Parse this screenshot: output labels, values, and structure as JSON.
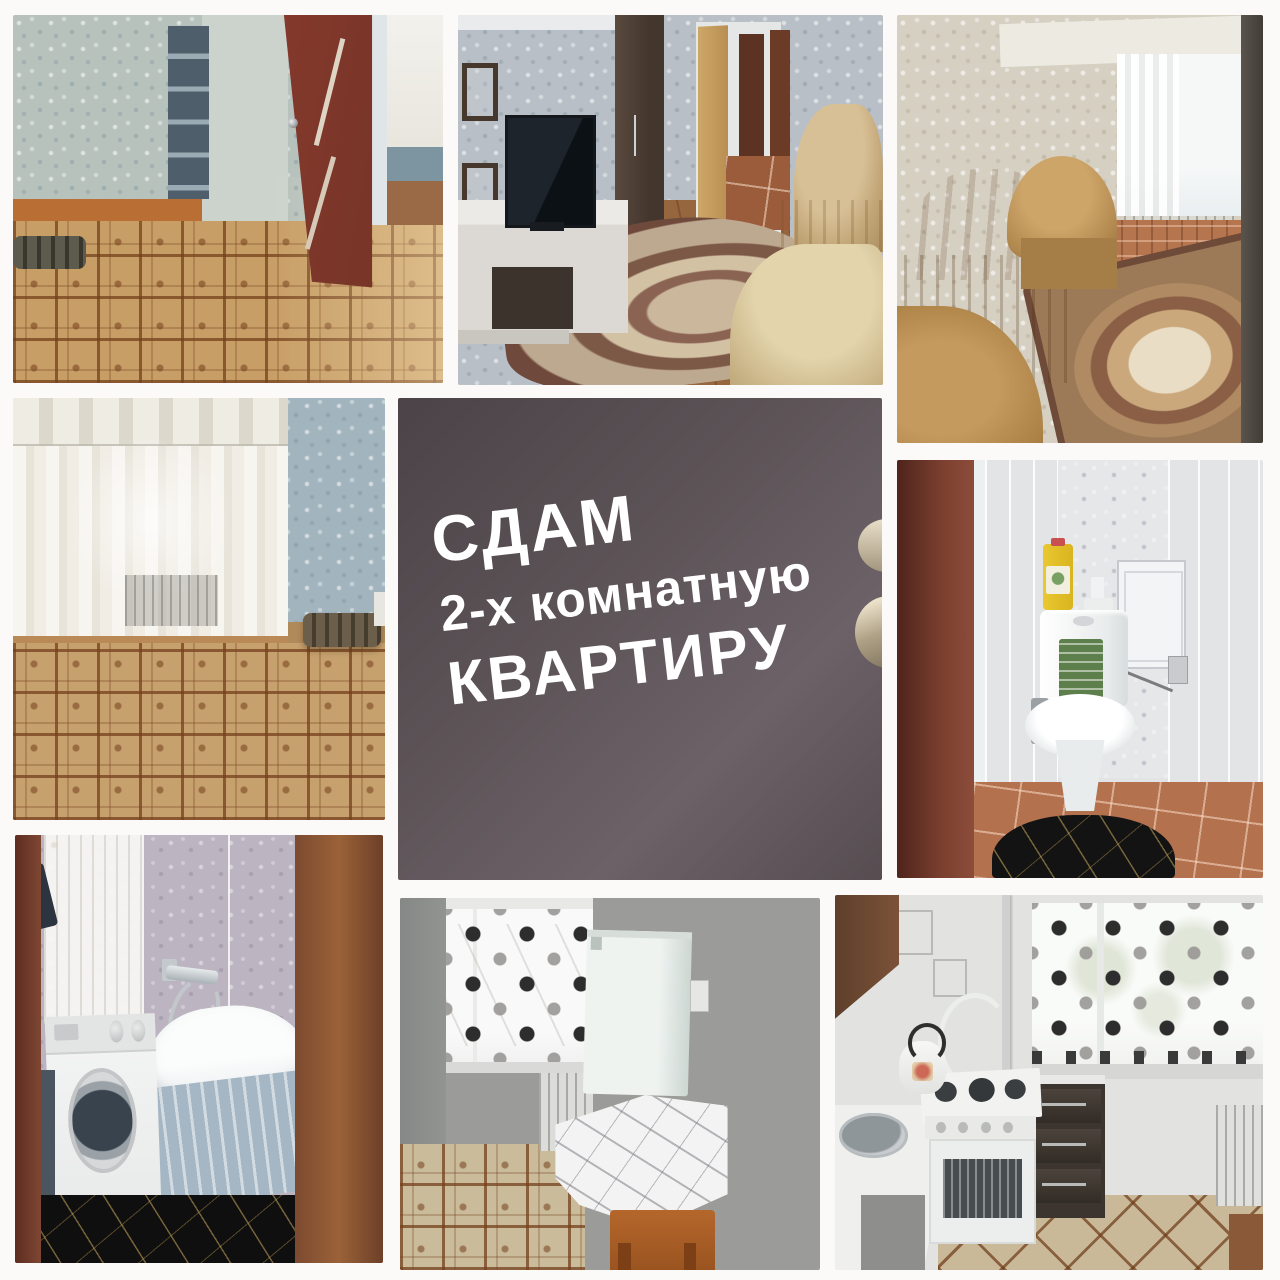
{
  "collage": {
    "background_color": "#fcfaf8",
    "title_card": {
      "line1": "СДАМ",
      "line2": "2-х комнатную",
      "line3": "КВАРТИРУ",
      "background_color": "#5a5156",
      "text_color": "#ffffff"
    },
    "photos": [
      {
        "name": "hallway-open-door"
      },
      {
        "name": "living-room-tv"
      },
      {
        "name": "living-room-sofas"
      },
      {
        "name": "empty-room-window"
      },
      {
        "name": "title-card"
      },
      {
        "name": "toilet"
      },
      {
        "name": "bathroom-washing-machine"
      },
      {
        "name": "room-fridge-table"
      },
      {
        "name": "kitchen-stove"
      }
    ]
  }
}
